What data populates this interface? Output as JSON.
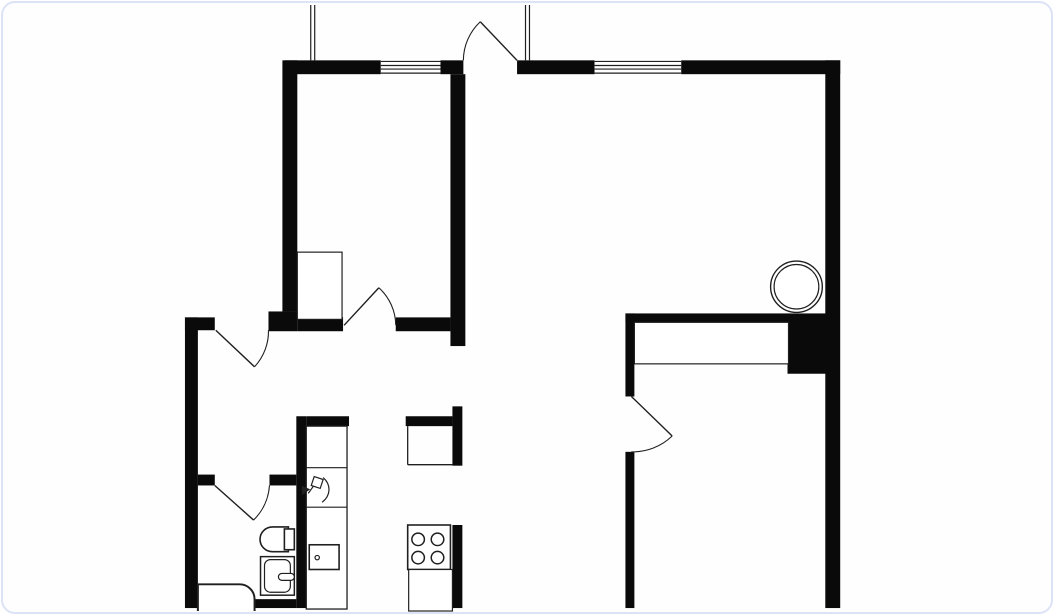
{
  "canvas": {
    "width": 1054,
    "height": 616,
    "background": "#fefefe",
    "card_border_color": "#dde3f6",
    "card_corner_radius": 14,
    "wall_color": "#0a0a0a",
    "line_color": "#1f1f1f",
    "window_fill": "#ffffff",
    "window_line_offsets": [
      1.1,
      5.2,
      8.8,
      12.9
    ]
  },
  "plan": {
    "walls": [
      {
        "name": "wall-top-west-a",
        "r": [
          283,
          58,
          97,
          14
        ]
      },
      {
        "name": "wall-top-west-jamb",
        "r": [
          440,
          58,
          23,
          14
        ]
      },
      {
        "name": "wall-top-east-a",
        "r": [
          517,
          58,
          78,
          14
        ]
      },
      {
        "name": "wall-top-east-b",
        "r": [
          682,
          58,
          160,
          14
        ]
      },
      {
        "name": "wall-right-exterior",
        "r": [
          827,
          58,
          15,
          554
        ]
      },
      {
        "name": "wall-bedroom2-west",
        "r": [
          281,
          58,
          15,
          254
        ]
      },
      {
        "name": "wall-bedroom2-west-foot",
        "r": [
          267,
          312,
          29,
          20
        ]
      },
      {
        "name": "wall-hall-north-left",
        "r": [
          296,
          318,
          46,
          14
        ]
      },
      {
        "name": "wall-hall-north-right",
        "r": [
          395,
          318,
          55,
          14
        ]
      },
      {
        "name": "wall-middle-vertical",
        "r": [
          450,
          72,
          15,
          275
        ]
      },
      {
        "name": "wall-entry-stub",
        "r": [
          183,
          318,
          30,
          13
        ]
      },
      {
        "name": "wall-left-exterior",
        "r": [
          183,
          318,
          13,
          294
        ]
      },
      {
        "name": "wall-bath-north-left",
        "r": [
          196,
          477,
          17,
          11
        ]
      },
      {
        "name": "wall-bath-north-right",
        "r": [
          268,
          477,
          27,
          11
        ]
      },
      {
        "name": "wall-bath-kitchen",
        "r": [
          295,
          418,
          10,
          194
        ]
      },
      {
        "name": "wall-counter-cap",
        "r": [
          305,
          418,
          43,
          10
        ]
      },
      {
        "name": "wall-island-cap",
        "r": [
          405,
          418,
          47,
          10
        ]
      },
      {
        "name": "wall-island-east",
        "r": [
          452,
          408,
          10,
          60
        ]
      },
      {
        "name": "wall-kitchen-east-lower",
        "r": [
          452,
          528,
          10,
          84
        ]
      },
      {
        "name": "wall-bedroom-west-upper",
        "r": [
          626,
          314,
          9,
          84
        ]
      },
      {
        "name": "wall-bedroom-west-lower",
        "r": [
          626,
          454,
          9,
          158
        ]
      },
      {
        "name": "wall-closet-north-band",
        "r": [
          626,
          314,
          164,
          9
        ]
      },
      {
        "name": "wall-shaft-block",
        "r": [
          789,
          314,
          39,
          61
        ]
      },
      {
        "name": "wall-bath-south-bar",
        "r": [
          251,
          603,
          44,
          9
        ]
      }
    ],
    "windows": [
      {
        "name": "window-bedroom2",
        "x": 380,
        "y": 58,
        "w": 60,
        "h": 14
      },
      {
        "name": "window-living",
        "x": 595,
        "y": 58,
        "w": 87,
        "h": 14
      }
    ],
    "rails": [
      {
        "name": "balcony-rail-left-a",
        "l": [
          309.5,
          2,
          309.5,
          58
        ]
      },
      {
        "name": "balcony-rail-left-b",
        "l": [
          313.5,
          2,
          313.5,
          58
        ]
      },
      {
        "name": "balcony-rail-right-a",
        "l": [
          525.5,
          2,
          525.5,
          58
        ]
      },
      {
        "name": "balcony-rail-right-b",
        "l": [
          529.5,
          2,
          529.5,
          58
        ]
      }
    ],
    "doors": [
      {
        "name": "door-balcony-top",
        "leaf": "M480 19 L517 58",
        "arc": "M463 58 A54 54 0 0 1 480 19"
      },
      {
        "name": "door-bedroom2",
        "leaf": "M343 326 L378 288",
        "arc": "M395 326 A52 52 0 0 0 378 288"
      },
      {
        "name": "door-entry",
        "leaf": "M214 331 L253 368",
        "arc": "M267 331 A53 53 0 0 1 253 368"
      },
      {
        "name": "door-bathroom",
        "leaf": "M213 488 L252 523",
        "arc": "M268 488 A54 54 0 0 1 252 523"
      },
      {
        "name": "door-bedroom-main",
        "leaf": "M632 398 L673 438",
        "arc": "M632 454 A57 57 0 0 0 673 438"
      }
    ],
    "fixtures": [
      {
        "name": "closet-bedroom2",
        "shapes": [
          {
            "t": "rect",
            "x": 296,
            "y": 252,
            "wd": 45,
            "ht": 68,
            "f": "#ffffff",
            "lw": 1.2
          }
        ]
      },
      {
        "name": "wardrobe-bedroom",
        "shapes": [
          {
            "t": "rect",
            "x": 635,
            "y": 323,
            "wd": 155,
            "ht": 42,
            "f": "#ffffff",
            "lw": 1.2
          }
        ]
      },
      {
        "name": "boiler-circle",
        "shapes": [
          {
            "t": "circle",
            "cx": 798,
            "cy": 287,
            "r": 26,
            "f": "#ffffff",
            "lw": 1.4
          },
          {
            "t": "circle",
            "cx": 798,
            "cy": 287,
            "r": 22.5,
            "lw": 1.2
          }
        ]
      },
      {
        "name": "kitchen-counter-left",
        "shapes": [
          {
            "t": "rect",
            "x": 305,
            "y": 428,
            "wd": 41,
            "ht": 185,
            "f": "#ffffff",
            "lw": 1.3
          },
          {
            "t": "line",
            "x1": 305,
            "y1": 470,
            "x2": 346,
            "y2": 470,
            "lw": 1.2
          },
          {
            "t": "line",
            "x1": 305,
            "y1": 510,
            "x2": 346,
            "y2": 510,
            "lw": 1.2
          }
        ]
      },
      {
        "name": "faucet-icon",
        "shapes": [
          {
            "t": "path",
            "d": "M313 479 L322 482 L319 491 L310 488 Z",
            "lw": 1.2
          },
          {
            "t": "path",
            "d": "M322 480 C330 487 330 498 321 505",
            "lw": 1.2
          },
          {
            "t": "path",
            "d": "M312 489 L307 496",
            "lw": 1.2
          },
          {
            "t": "path",
            "d": "M308 492 L301 489 L301 497 Z",
            "f": "#222222",
            "lw": 1
          }
        ]
      },
      {
        "name": "kitchen-sink-icon",
        "shapes": [
          {
            "t": "rect",
            "x": 308,
            "y": 548,
            "wd": 30,
            "ht": 25,
            "f": "#ffffff",
            "lw": 1.6
          },
          {
            "t": "circle",
            "cx": 316,
            "cy": 561,
            "r": 2.2,
            "lw": 1.2
          }
        ]
      },
      {
        "name": "duct-shaft",
        "shapes": [
          {
            "t": "line",
            "x1": 407,
            "y1": 428,
            "x2": 407,
            "y2": 467,
            "lw": 1.3
          },
          {
            "t": "line",
            "x1": 407,
            "y1": 467,
            "x2": 452,
            "y2": 467,
            "lw": 1.3
          }
        ]
      },
      {
        "name": "stove-icon",
        "shapes": [
          {
            "t": "rect",
            "x": 407,
            "y": 528,
            "wd": 43,
            "ht": 45,
            "f": "#ffffff",
            "lw": 1.6
          },
          {
            "t": "circle",
            "cx": 417.5,
            "cy": 542.5,
            "r": 6.3,
            "lw": 1.5
          },
          {
            "t": "circle",
            "cx": 437,
            "cy": 542.5,
            "r": 6.3,
            "lw": 1.5
          },
          {
            "t": "circle",
            "cx": 417.5,
            "cy": 561,
            "r": 6.3,
            "lw": 1.5
          },
          {
            "t": "circle",
            "cx": 437,
            "cy": 561,
            "r": 6.3,
            "lw": 1.5
          }
        ]
      },
      {
        "name": "counter-below-stove",
        "shapes": [
          {
            "t": "rect",
            "x": 408,
            "y": 573,
            "wd": 44,
            "ht": 42,
            "f": "#ffffff",
            "lw": 1.2
          }
        ]
      },
      {
        "name": "toilet-icon",
        "shapes": [
          {
            "t": "path",
            "d": "M287 530 L271 530 A12.5 12.5 0 0 0 258.5 542.5 A12.5 12.5 0 0 0 271 555 L287 555 Z",
            "f": "#ffffff",
            "lw": 1.6
          },
          {
            "t": "rect",
            "x": 283,
            "y": 532,
            "wd": 10,
            "ht": 21,
            "f": "#ffffff",
            "lw": 1.6
          }
        ]
      },
      {
        "name": "washbasin-icon",
        "shapes": [
          {
            "t": "rect",
            "x": 259,
            "y": 560,
            "wd": 34,
            "ht": 39,
            "f": "#ffffff",
            "lw": 1.5
          },
          {
            "t": "rect",
            "x": 263,
            "y": 563,
            "wd": 26,
            "ht": 33,
            "rx": 6,
            "lw": 1.2
          },
          {
            "t": "rect",
            "x": 277,
            "y": 577,
            "wd": 16,
            "ht": 7,
            "rx": 3.5,
            "f": "#ffffff",
            "lw": 1.2
          }
        ]
      },
      {
        "name": "bathtub-icon",
        "shapes": [
          {
            "t": "path",
            "d": "M196 615 L196 588 L238 588 A15 15 0 0 1 253 603 L253 615",
            "f": "#ffffff",
            "lw": 2
          }
        ]
      }
    ]
  }
}
